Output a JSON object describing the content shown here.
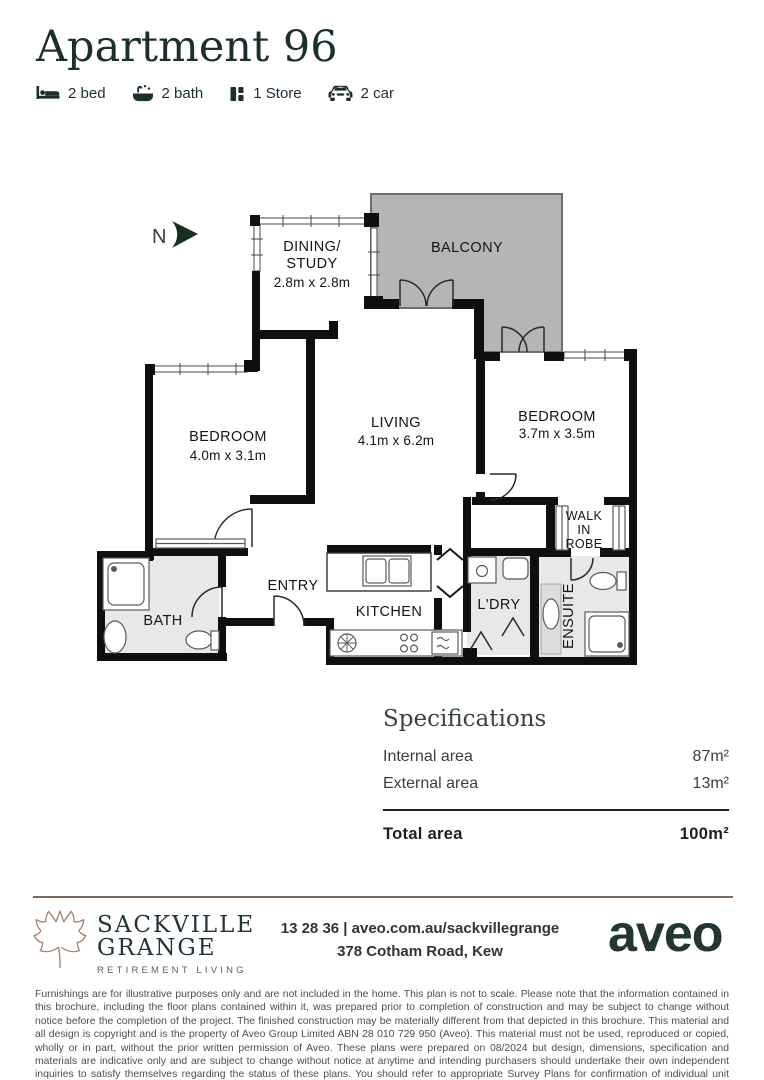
{
  "header": {
    "title": "Apartment 96",
    "features": [
      {
        "icon": "bed-icon",
        "label": "2 bed"
      },
      {
        "icon": "bath-icon",
        "label": "2 bath"
      },
      {
        "icon": "store-icon",
        "label": "1 Store"
      },
      {
        "icon": "car-icon",
        "label": "2 car"
      }
    ]
  },
  "floor_plan": {
    "north_label": "N",
    "rooms": {
      "dining": {
        "line1": "DINING/",
        "line2": "STUDY",
        "dims": "2.8m x 2.8m"
      },
      "balcony": {
        "name": "BALCONY"
      },
      "bedroom1": {
        "name": "BEDROOM",
        "dims": "4.0m x 3.1m"
      },
      "living": {
        "name": "LIVING",
        "dims": "4.1m x 6.2m"
      },
      "bedroom2": {
        "name": "BEDROOM",
        "dims": "3.7m x 3.5m"
      },
      "walk_in_robe": {
        "line1": "WALK",
        "line2": "IN",
        "line3": "ROBE"
      },
      "entry": {
        "name": "ENTRY"
      },
      "kitchen": {
        "name": "KITCHEN"
      },
      "laundry": {
        "name": "L'DRY"
      },
      "bath": {
        "name": "BATH"
      },
      "ensuite": {
        "name": "ENSUITE"
      }
    }
  },
  "specifications": {
    "heading": "Specifications",
    "rows": [
      {
        "label": "Internal area",
        "value": "87m²"
      },
      {
        "label": "External area",
        "value": "13m²"
      }
    ],
    "total": {
      "label": "Total area",
      "value": "100m²"
    }
  },
  "footer": {
    "brand": {
      "line1": "SACKVILLE",
      "line2": "GRANGE",
      "tagline": "RETIREMENT LIVING"
    },
    "contact_line1": "13 28 36 | aveo.com.au/sackvillegrange",
    "contact_line2": "378 Cotham Road, Kew",
    "logo_text": "aveo"
  },
  "disclaimer": "Furnishings are for illustrative purposes only and are not included in the home. This plan is not to scale. Please note that the information contained in this brochure, including the floor plans contained within it, was prepared prior to completion of construction and may be subject to change without notice before the completion of the project. The finished construction may be materially different from that depicted in this brochure. This material and all design is copyright and is the property of Aveo Group Limited ABN 28 010 729 950 (Aveo). This material must not be used, reproduced or copied, wholly or in part, without the prior written permission of Aveo. These plans were prepared on 08/2024 but design, dimensions, specification and materials are indicative only and are subject to change without notice at anytime and intending purchasers should undertake their own independent inquiries to satisfy themselves regarding the status of these plans. You should refer to appropriate Survey Plans for confirmation of individual unit areas.",
  "colors": {
    "brand_green": "#1c3125",
    "leaf_brown": "#a8826f",
    "divider_brown": "#7e6a5d",
    "balcony_gray": "#b5b5b5",
    "wet_area_gray": "#e8e8e8",
    "wall_black": "#0f0f0f"
  }
}
